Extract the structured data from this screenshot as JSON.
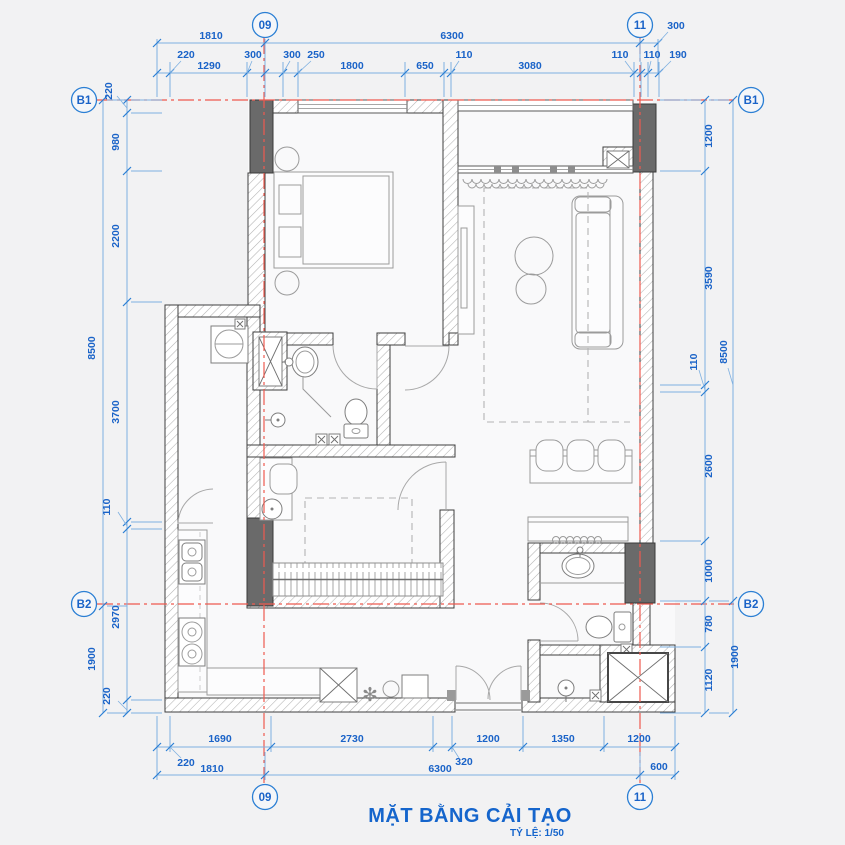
{
  "title": {
    "main": "MẶT BẰNG CẢI TẠO",
    "scale": "TỶ LỆ: 1/50"
  },
  "grid_bubbles": {
    "top_09": "09",
    "top_11": "11",
    "bottom_09": "09",
    "bottom_11": "11",
    "b1_left": "B1",
    "b1_right": "B1",
    "b2_left": "B2",
    "b2_right": "B2"
  },
  "dims": {
    "top_outer": [
      "1810",
      "6300",
      "300"
    ],
    "top_inner": [
      "220",
      "1290",
      "300",
      "300",
      "250",
      "1800",
      "650",
      "110",
      "3080",
      "110",
      "110",
      "190"
    ],
    "bottom_inner": [
      "220",
      "1690",
      "2730",
      "320",
      "1200",
      "1350",
      "1200"
    ],
    "bottom_outer": [
      "1810",
      "6300",
      "600"
    ],
    "left_inner": [
      "220",
      "980",
      "2200",
      "3700",
      "110",
      "2970",
      "220"
    ],
    "left_outer": [
      "8500",
      "1900"
    ],
    "right_inner": [
      "1200",
      "3590",
      "110",
      "2600",
      "1000",
      "780",
      "1120"
    ],
    "right_outer": [
      "8500",
      "1900"
    ]
  },
  "icons": {
    "snowflake": "✻"
  },
  "colors": {
    "dimension_blue": "#1a63c8",
    "grid_red": "#ee5a4f",
    "wall_dark": "#3f3f3f",
    "column_gray": "#6a6a6a",
    "furniture_gray": "#9b9b9b",
    "background": "#f2f2f3"
  }
}
